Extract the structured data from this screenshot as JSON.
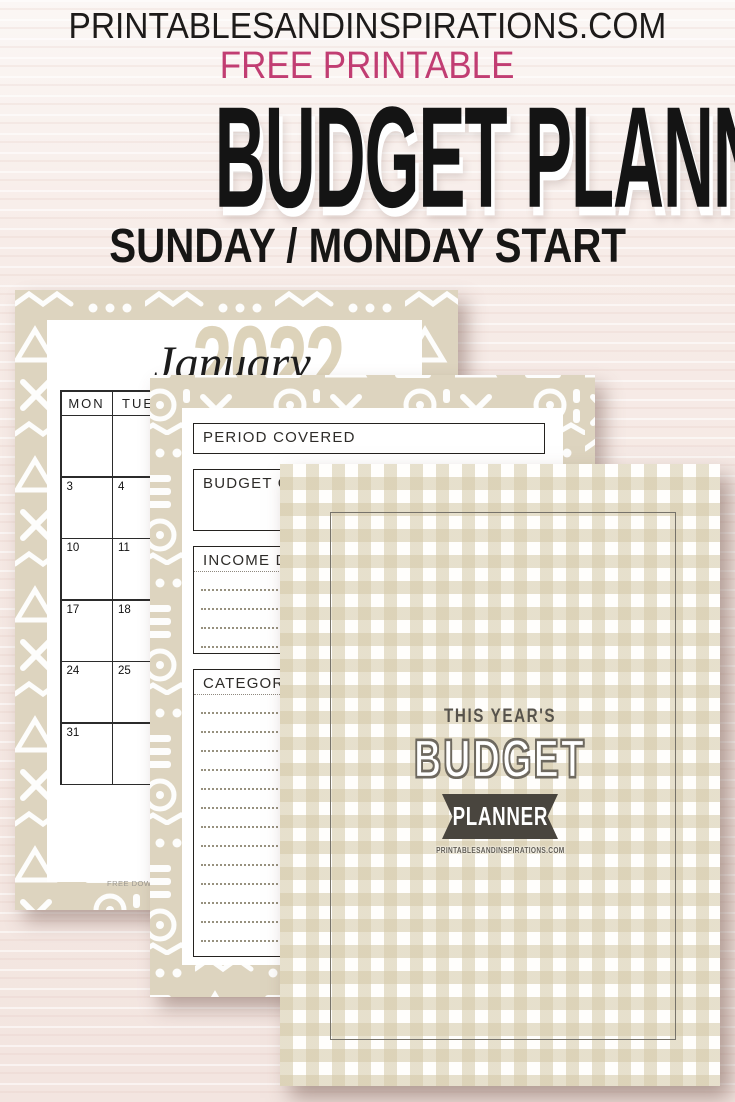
{
  "header": {
    "site": "PRINTABLESANDINSPIRATIONS.COM",
    "tagline": "FREE PRINTABLE",
    "title": "BUDGET PLANNER",
    "subtitle": "SUNDAY / MONDAY START",
    "accent_color": "#c13d72",
    "title_color": "#141414"
  },
  "calendar_page": {
    "year": "2022",
    "month": "January",
    "day_headers": [
      "MON",
      "TUE"
    ],
    "weeks": [
      [
        "",
        ""
      ],
      [
        "3",
        "4"
      ],
      [
        "10",
        "11"
      ],
      [
        "17",
        "18"
      ],
      [
        "24",
        "25"
      ],
      [
        "31",
        ""
      ]
    ],
    "footer_text": "FREE DOWNLOAD"
  },
  "form_page": {
    "fields": [
      {
        "label": "PERIOD COVERED",
        "dotted_lines": 0
      },
      {
        "label": "BUDGET GOALS",
        "dotted_lines": 0
      },
      {
        "label": "INCOME DESCRIPTION",
        "dotted_lines": 5
      },
      {
        "label": "CATEGORIES",
        "dotted_lines": 14
      }
    ]
  },
  "cover_page": {
    "eyebrow": "THIS YEAR'S",
    "title": "BUDGET",
    "banner": "PLANNER",
    "site": "PRINTABLESANDINSPIRATIONS.COM",
    "banner_color": "#49453e"
  },
  "colors": {
    "wood_background": "#f4e7e2",
    "mudcloth_beige": "#ddd4bf",
    "gingham_beige": "#e2dac2",
    "pink_accent": "#c13d72"
  }
}
